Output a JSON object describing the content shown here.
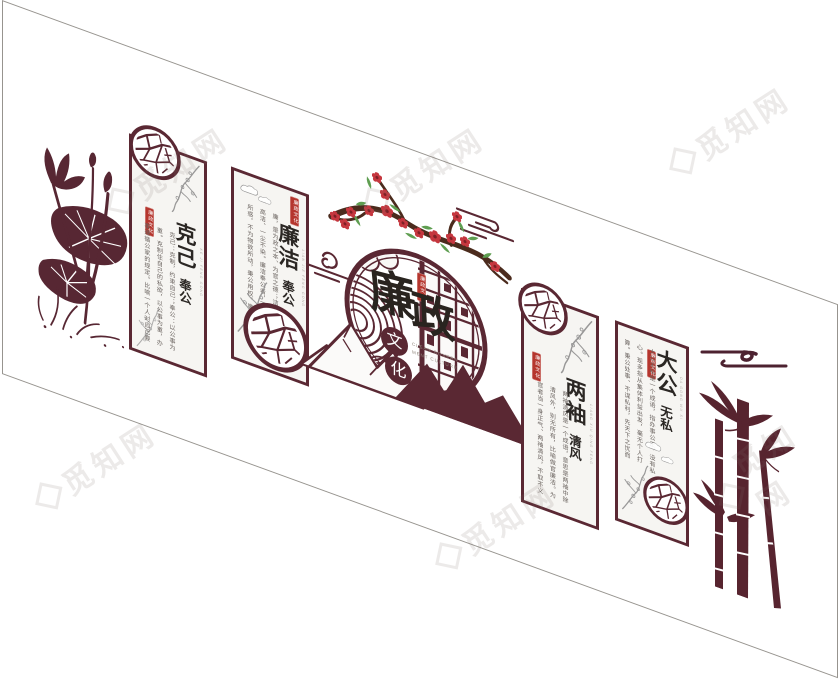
{
  "theme": "廉政文化 staircase culture wall design",
  "colors": {
    "primary_maroon": "#5a2833",
    "silhouette_maroon": "#572733",
    "seal_red": "#b5362e",
    "blossom_red": "#c5373f",
    "leaf_green": "#5f9e51",
    "branch_brown": "#4b2b1d",
    "ink_gray": "#8f8f8f",
    "panel_bg": "#f6f5f2",
    "frame_line": "#97948f",
    "calligraphy_black": "#29241f"
  },
  "watermark": {
    "text": "觅知网"
  },
  "center": {
    "title_char_1": "廉",
    "title_char_2": "政",
    "sub_char_1": "文",
    "sub_char_2": "化",
    "caption_line1": "CLEAN GOVERN",
    "caption_line2": "MENT CULTURE",
    "seal_text": "廉政文化"
  },
  "panels": [
    {
      "id": "keji-fenggong",
      "title_main": "克己",
      "title_sub": "奉公",
      "pinyin": "KE JI FENG GONG",
      "seal_text": "廉政文化",
      "desc": "克己：克制，约束自己；奉公：以公事为重。克制住自己的私欲，以公事为重，办事遵循公家的规定。比喻一个人对自己要求严格，一心为公。"
    },
    {
      "id": "lianjie-fenggong",
      "title_main": "廉洁",
      "title_sub": "奉公",
      "pinyin": "LIAN JIE FENG GONG",
      "seal_text": "廉政文化",
      "desc": "廉，是为政之本、为官之德；洁，是清白高洁、一尘不染。廉洁奉公者，不为名利所惑，不为物欲所动，秉公用权，廉洁自律，一心为公。"
    },
    {
      "id": "liangxiu-qingfeng",
      "title_main": "两袖",
      "title_sub": "清风",
      "pinyin": "LIANG XIU QING FENG",
      "seal_text": "廉政文化",
      "desc": "两袖清风是一个成语，意思是两袖中除清风外，别无所有，比喻做官廉洁。为官者当一身正气、两袖清风，不取不义之财，清清白白做人，堂堂正正做事。"
    },
    {
      "id": "dagong-wusi",
      "title_main": "大公",
      "title_sub": "无私",
      "pinyin": "DA GONG WU SI",
      "seal_text": "廉政文化",
      "desc": "大公无私是一个成语，指办事公正，没有私心。现多指从集体利益出发，毫无个人打算。秉公处事、不谋私利，先天下之忧而忧，后天下之乐而乐。"
    }
  ],
  "icons": [
    "lotus-icon",
    "ice-crack-circle-icon",
    "ink-plum-icon",
    "ink-cloud-icon",
    "plum-blossom-branch-icon",
    "mountain-icon",
    "window-lattice-icon",
    "wave-pattern-icon",
    "bamboo-icon",
    "cloud-motif-icon",
    "seal-stamp-icon",
    "watermark-logo-icon"
  ]
}
